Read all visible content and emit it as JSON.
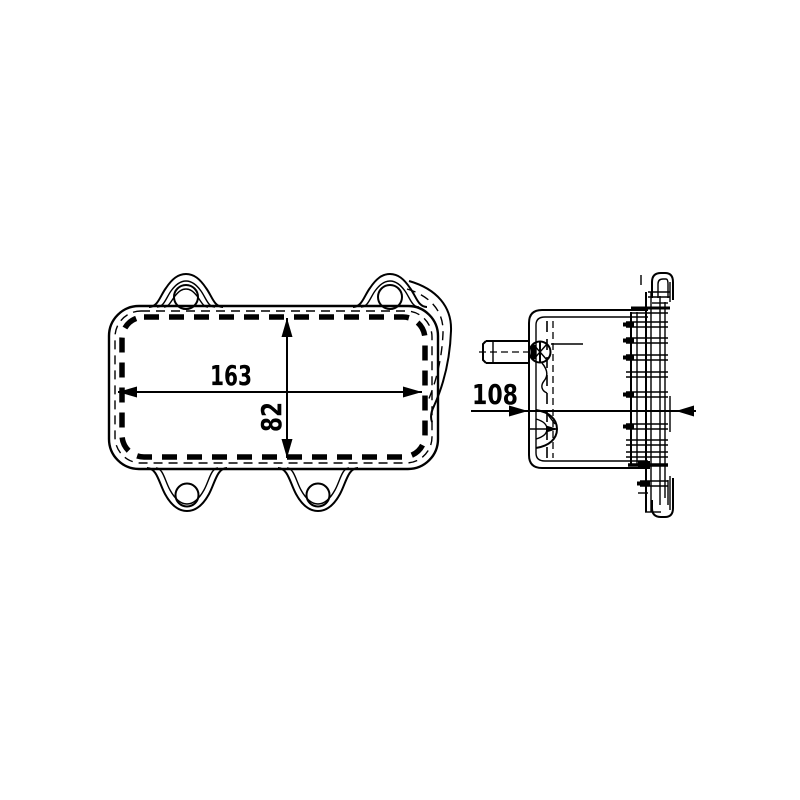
{
  "canvas": {
    "background": "#ffffff",
    "line_color": "#000000"
  },
  "dimensions": {
    "front_width": "163",
    "front_height": "82",
    "side_depth": "108"
  }
}
